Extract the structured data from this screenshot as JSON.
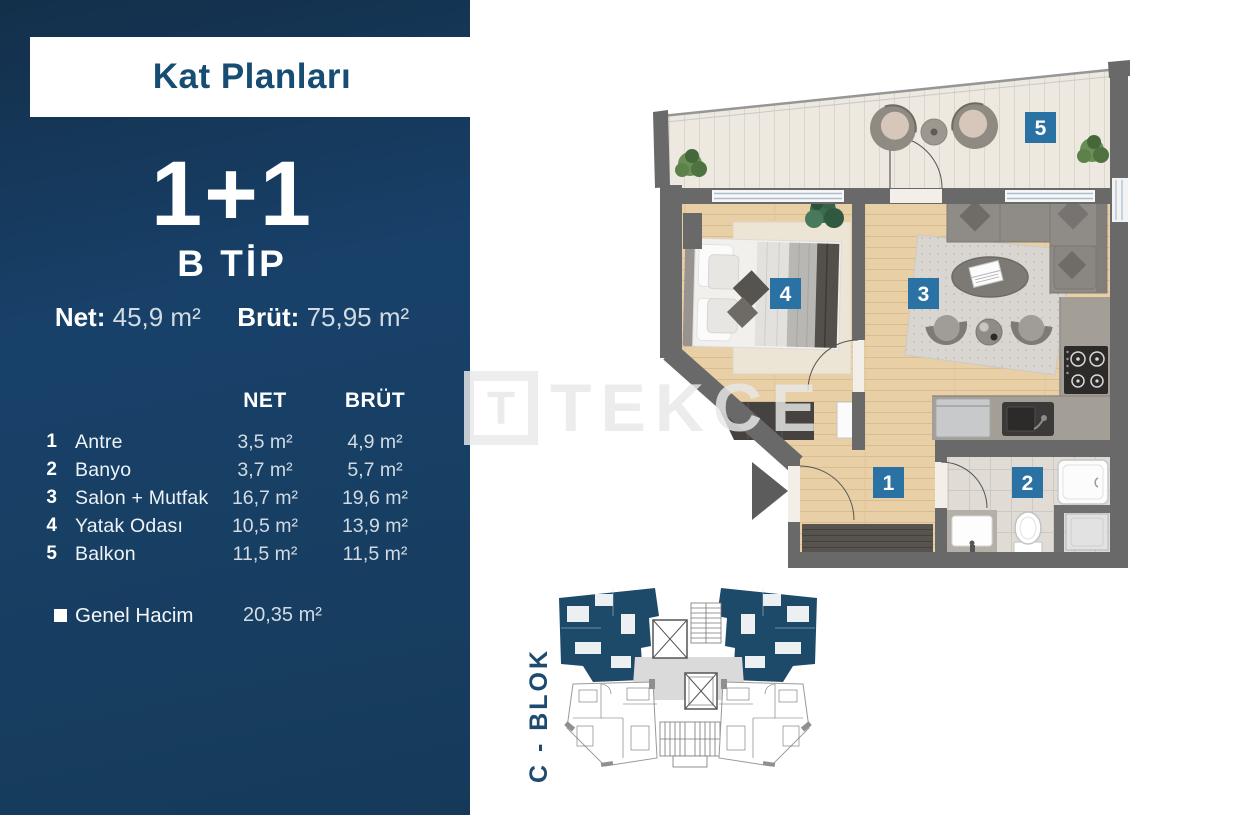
{
  "header": {
    "title": "Kat Planları"
  },
  "unit": {
    "type": "1+1",
    "subtype": "B TİP",
    "net_label": "Net:",
    "net_value": "45,9 m²",
    "brut_label": "Brüt:",
    "brut_value": "75,95 m²"
  },
  "table": {
    "net_header": "NET",
    "brut_header": "BRÜT",
    "rows": [
      {
        "num": "1",
        "name": "Antre",
        "net": "3,5 m²",
        "brut": "4,9 m²"
      },
      {
        "num": "2",
        "name": "Banyo",
        "net": "3,7 m²",
        "brut": "5,7 m²"
      },
      {
        "num": "3",
        "name": "Salon + Mutfak",
        "net": "16,7 m²",
        "brut": "19,6 m²"
      },
      {
        "num": "4",
        "name": "Yatak Odası",
        "net": "10,5 m²",
        "brut": "13,9 m²"
      },
      {
        "num": "5",
        "name": "Balkon",
        "net": "11,5 m²",
        "brut": "11,5 m²"
      }
    ],
    "footer_label": "Genel Hacim",
    "footer_value": "20,35 m²"
  },
  "floorplan": {
    "room_numbers": {
      "hall": "1",
      "bath": "2",
      "living": "3",
      "bedroom": "4",
      "balcony": "5"
    },
    "badge_color": "#2a71a4",
    "wall_color": "#696969",
    "wood_color": "#e8cfa6",
    "balcony_floor_color": "#ede9e0",
    "tile_color": "#e0dcd5"
  },
  "watermark": {
    "logo_letter": "T",
    "brand": "TEKCE"
  },
  "keyplan": {
    "block_label": "C - BLOK",
    "highlight_color": "#1e4a6a"
  },
  "colors": {
    "sidebar_bg": "#17406a",
    "title_text": "#174d72",
    "badge_blue": "#2a71a4"
  }
}
